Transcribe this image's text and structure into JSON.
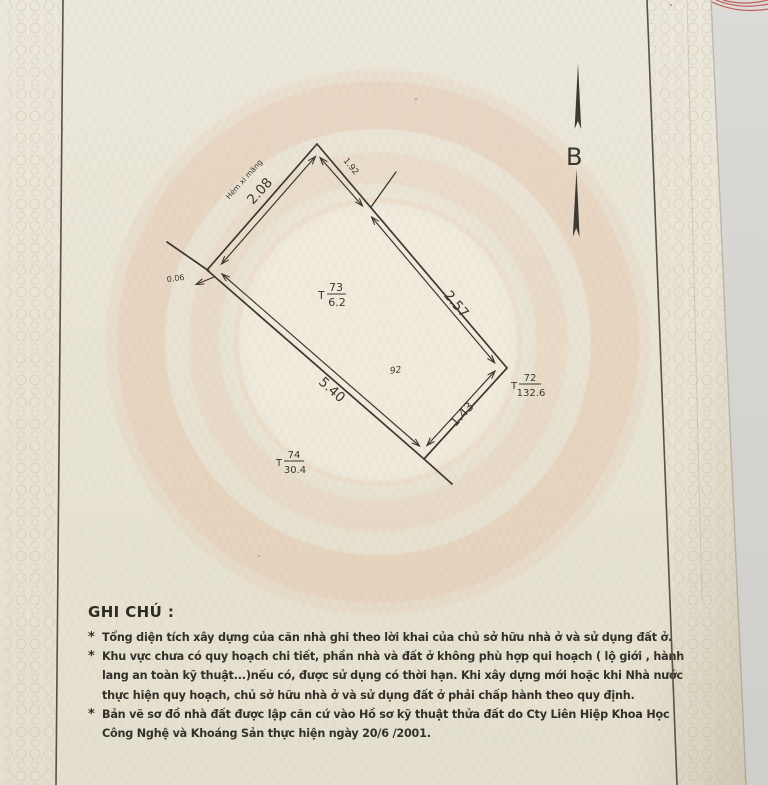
{
  "north_arrow": {
    "label": "B"
  },
  "plot": {
    "street_label": "Hẻm xi măng",
    "dims": {
      "top_left": "2.08",
      "seg_upper": "1.92",
      "seg_lower": "2.57",
      "right": "1.43",
      "bottom": "5.40",
      "offset": "0.06"
    },
    "area_label": "92",
    "points": {
      "p73": {
        "t": "T",
        "num": "73",
        "den": "6.2"
      },
      "p72": {
        "t": "T",
        "num": "72",
        "den": "132.6"
      },
      "p74": {
        "t": "T",
        "num": "74",
        "den": "30.4"
      }
    }
  },
  "notes": {
    "title": "GHI CHÚ :",
    "lines": [
      {
        "b": "*",
        "t": "Tổng diện tích xây dựng của căn nhà ghi theo lời khai của chủ sở hữu nhà ở và sử dụng đất ở."
      },
      {
        "b": "*",
        "t": "Khu vực chưa có quy hoạch chi tiết, phần nhà và đất ở không phù hợp qui hoạch ( lộ giới , hành"
      },
      {
        "b": "",
        "t": "lang an toàn kỹ thuật...)nếu có, được sử dụng có thời hạn. Khi xây dựng mới hoặc khi Nhà nước"
      },
      {
        "b": "",
        "t": "thực hiện quy hoạch, chủ sở hữu nhà ở và sử dụng đất ở phải chấp hành theo quy định."
      },
      {
        "b": "*",
        "t": "Bản vẽ sơ đồ nhà đất được lập căn cứ vào Hồ sơ kỹ thuật thửa đất do Cty Liên Hiệp Khoa Học"
      },
      {
        "b": "",
        "t": "Công Nghệ và Khoáng Sản thực hiện ngày 20/6 /2001."
      }
    ]
  },
  "colors": {
    "ink": "#3a372e",
    "paper": "#e8e4d5",
    "watermark": "#e4b294",
    "red_marks": "#b84a42"
  }
}
